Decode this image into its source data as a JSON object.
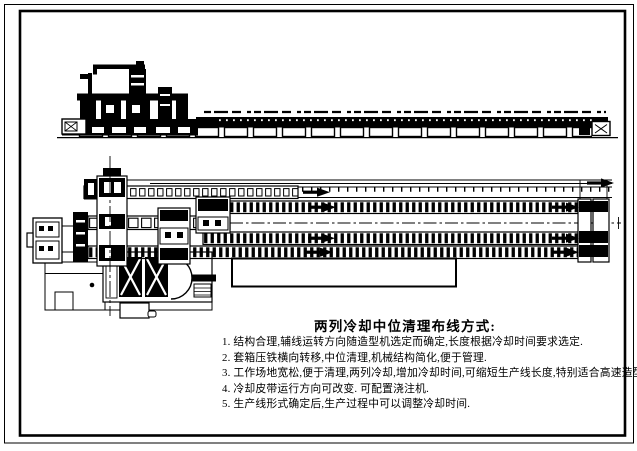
{
  "colors": {
    "line": "#000000",
    "background": "#ffffff"
  },
  "notes": {
    "title": "两列冷却中位清理布线方式:",
    "items": [
      "1. 结构合理,辅线运转方向随造型机选定而确定,长度根据冷却时间要求选定.",
      "2. 套箱压铁横向转移,中位清理,机械结构简化,便于管理.",
      "3. 工作场地宽松,便于清理,两列冷却,增加冷却时间,可缩短生产线长度,特别适合高速造型机.",
      "4. 冷却皮带运行方向可改变. 可配置浇注机.",
      "5. 生产线形式确定后,生产过程中可以调整冷却时间."
    ]
  }
}
